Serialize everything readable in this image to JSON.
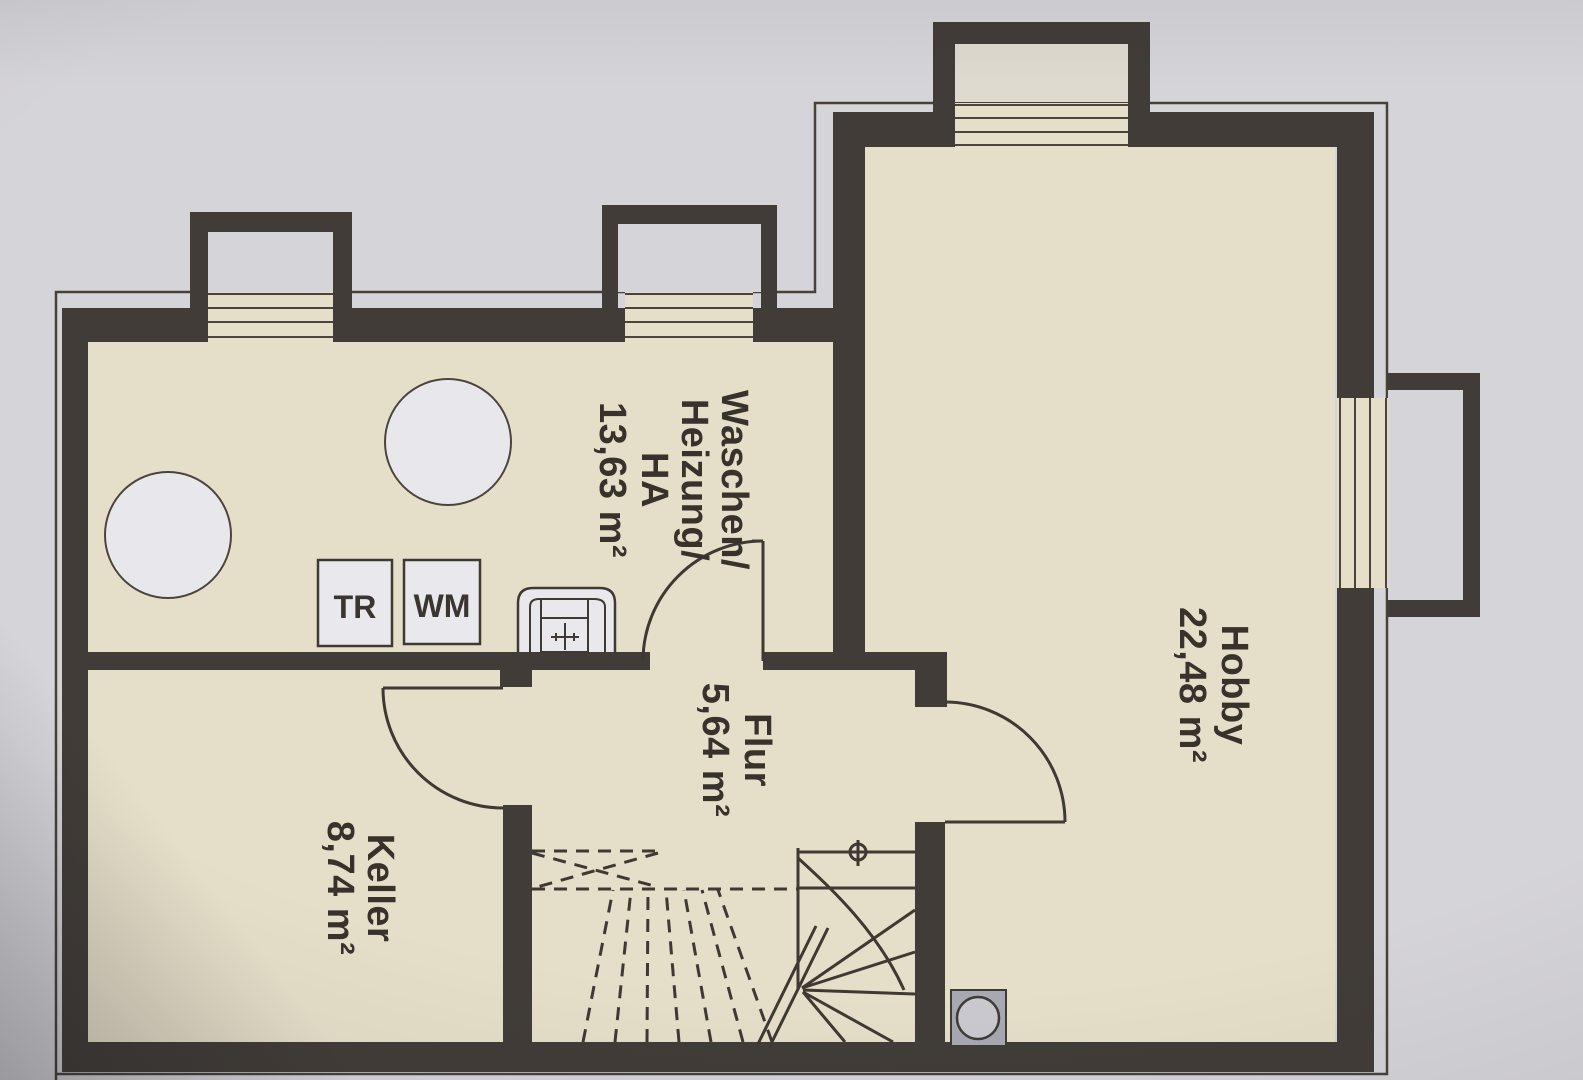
{
  "plan": {
    "type": "basement-floor-plan",
    "rooms": {
      "waschen": {
        "line1": "Waschen/",
        "line2": "Heizung/",
        "line3": "HA",
        "area": "13,63 m²"
      },
      "hobby": {
        "name": "Hobby",
        "area": "22,48 m²"
      },
      "flur": {
        "name": "Flur",
        "area": "5,64 m²"
      },
      "keller": {
        "name": "Keller",
        "area": "8,74 m²"
      }
    },
    "appliances": {
      "dryer": "TR",
      "washer": "WM"
    },
    "colors": {
      "background": "#d5d4d8",
      "wall": "#413c37",
      "floor": "#e5dfc9",
      "line": "#3e3933",
      "fixture_fill": "#e9e8ed",
      "sump_fill": "#a8a8b2",
      "label_text": "#37322c"
    }
  }
}
